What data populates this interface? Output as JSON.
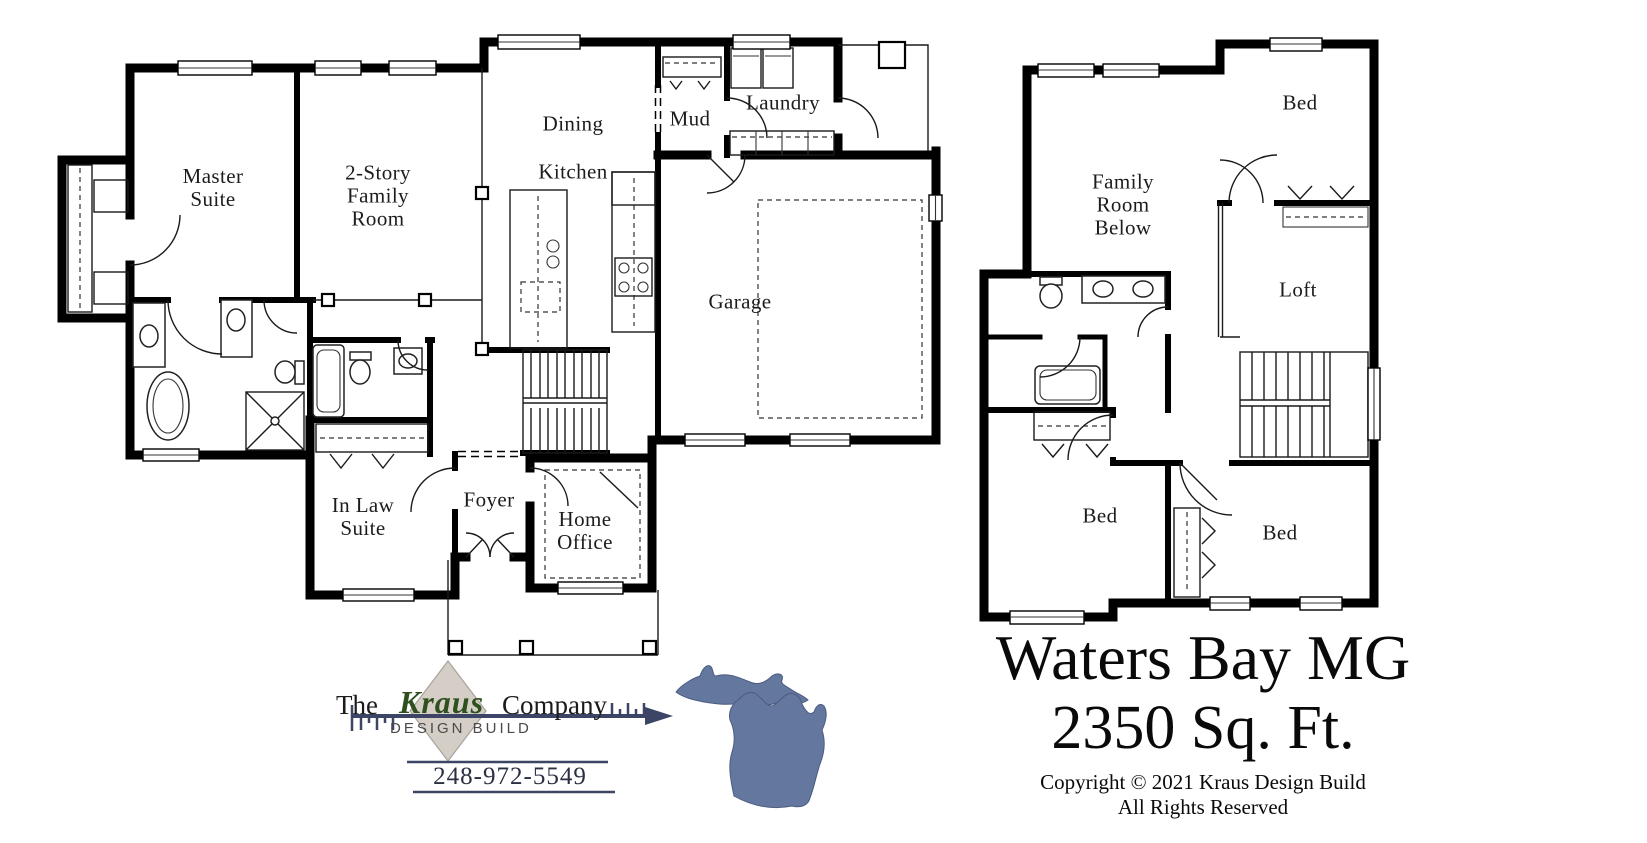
{
  "first_floor": {
    "labels": [
      {
        "id": "master-suite",
        "text": "Master\nSuite"
      },
      {
        "id": "family-room",
        "text": "2-Story\nFamily\nRoom"
      },
      {
        "id": "dining",
        "text": "Dining"
      },
      {
        "id": "kitchen",
        "text": "Kitchen"
      },
      {
        "id": "mud",
        "text": "Mud"
      },
      {
        "id": "laundry",
        "text": "Laundry"
      },
      {
        "id": "garage",
        "text": "Garage"
      },
      {
        "id": "in-law-suite",
        "text": "In Law\nSuite"
      },
      {
        "id": "foyer",
        "text": "Foyer"
      },
      {
        "id": "home-office",
        "text": "Home\nOffice"
      }
    ]
  },
  "second_floor": {
    "labels": [
      {
        "id": "family-room-below",
        "text": "Family\nRoom\nBelow"
      },
      {
        "id": "bed-upper",
        "text": "Bed"
      },
      {
        "id": "loft",
        "text": "Loft"
      },
      {
        "id": "bed-left",
        "text": "Bed"
      },
      {
        "id": "bed-right",
        "text": "Bed"
      }
    ]
  },
  "logo": {
    "prefix": "The",
    "brand": "Kraus",
    "suffix": "Company",
    "tagline": "DESIGN BUILD",
    "phone": "248-972-5549",
    "brand_color": "#2e4f1e",
    "arrow_color": "#3d4566",
    "diamond_color": "#d5cec6",
    "michigan_color": "#64779e"
  },
  "title_block": {
    "plan_name": "Waters Bay MG",
    "area": "2350 Sq. Ft.",
    "copyright": "Copyright © 2021 Kraus Design Build",
    "rights": "All Rights Reserved"
  }
}
